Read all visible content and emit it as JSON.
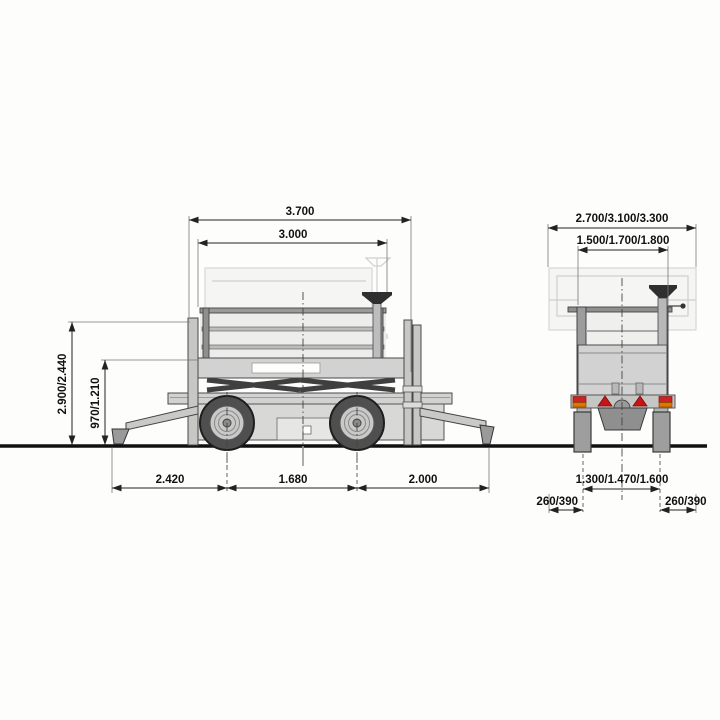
{
  "diagram": {
    "type": "technical-dimensional-drawing",
    "subject": "trailer-mounted scissor lift, side view and rear view",
    "views": {
      "side": {
        "dims": {
          "overall_length": "3.700",
          "inner_length": "3.000",
          "height": "2.900/2.440",
          "platform_height": "970/1.210",
          "rear_span": "2.420",
          "wheelbase": "1.680",
          "front_span": "2.000"
        }
      },
      "rear": {
        "dims": {
          "overall_width": "2.700/3.100/3.300",
          "inner_width": "1.500/1.700/1.800",
          "track": "1.300/1.470/1.600",
          "left_offset": "260/390",
          "right_offset": "260/390"
        }
      }
    },
    "colors": {
      "background": "#fdfdfb",
      "outline": "#3a3a3a",
      "body_fill": "#d2d2d2",
      "dark_fill": "#8f8f8f",
      "tire": "#4f4f4f",
      "ghost": "#d4d4d3",
      "reflector_red": "#c81414",
      "lamp_amber": "#dd7700",
      "ground": "#111111",
      "dim_text": "#111111"
    }
  }
}
